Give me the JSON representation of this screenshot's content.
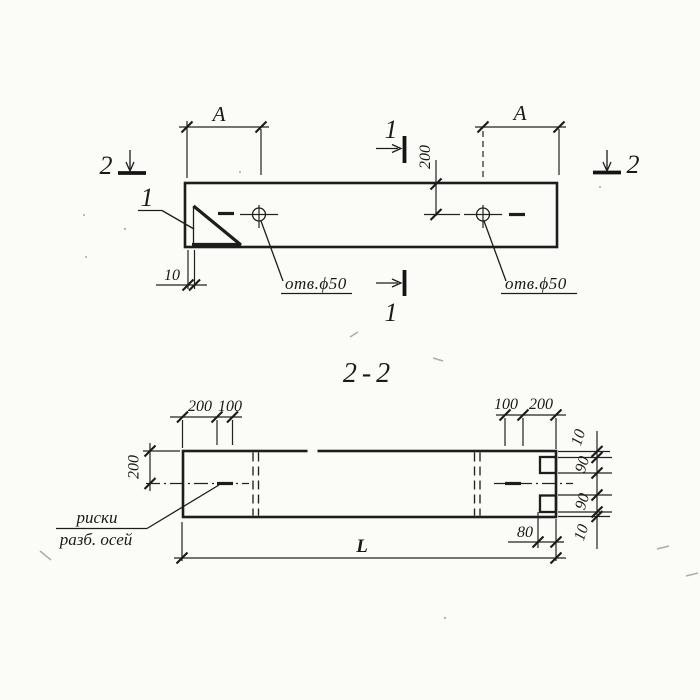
{
  "colors": {
    "ink": "#1e1d1b",
    "paper": "#fbfbf8"
  },
  "top_view": {
    "cut_left_label": "2",
    "cut_right_label": "2",
    "cut_top_label": "1",
    "cut_bottom_label": "1",
    "detail_callout_label": "1",
    "dim_a_left": "A",
    "dim_a_right": "A",
    "dim_hole_offset": "200",
    "dim_plate_thickness": "10",
    "hole_label_left": "отв.ϕ50",
    "hole_label_right": "отв.ϕ50"
  },
  "section_view": {
    "title": "2-2",
    "dims_top_left": [
      "200",
      "100"
    ],
    "dims_top_right": [
      "100",
      "200"
    ],
    "dim_half_height": "200",
    "dims_right_edge": [
      "10",
      "90",
      "90",
      "10"
    ],
    "dim_notch_depth": "80",
    "dim_length": "L",
    "axis_note_line1": "риски",
    "axis_note_line2": "разб. осей"
  }
}
